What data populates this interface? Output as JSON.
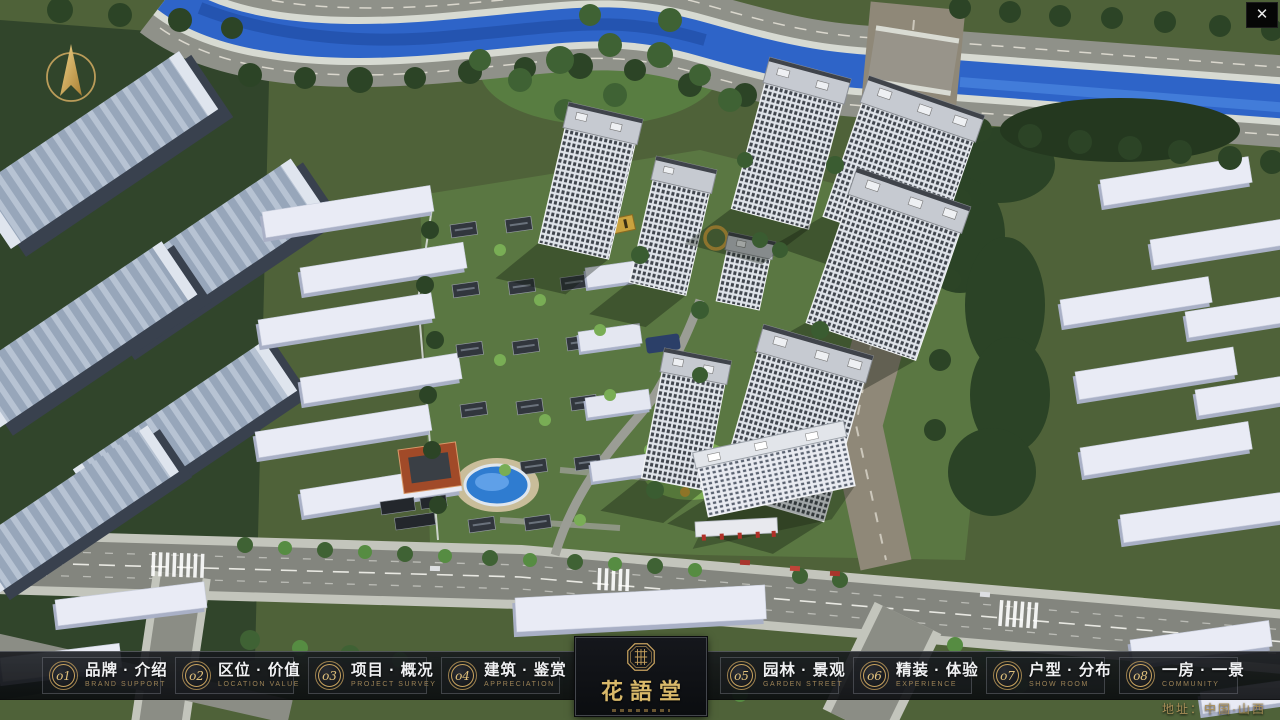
{
  "window": {
    "close_glyph": "✕"
  },
  "scene": {
    "description": "aerial 3D masterplan render of residential community"
  },
  "nav": {
    "items": [
      {
        "num": "o1",
        "zh": "品牌 · 介绍",
        "en": "BRAND SUPPORT"
      },
      {
        "num": "o2",
        "zh": "区位 · 价值",
        "en": "LOCATION VALUE"
      },
      {
        "num": "o3",
        "zh": "项目 · 概况",
        "en": "PROJECT SURVEY"
      },
      {
        "num": "o4",
        "zh": "建筑 · 鉴赏",
        "en": "APPRECIATION"
      },
      {
        "num": "o5",
        "zh": "园林 · 景观",
        "en": "GARDEN STREET"
      },
      {
        "num": "o6",
        "zh": "精装 · 体验",
        "en": "EXPERIENCE"
      },
      {
        "num": "o7",
        "zh": "户型 · 分布",
        "en": "SHOW ROOM"
      },
      {
        "num": "o8",
        "zh": "一房 · 一景",
        "en": "COMMUNITY"
      }
    ],
    "logo": {
      "title": "花語堂"
    },
    "address": "地址：中国·山西"
  },
  "colors": {
    "gold": "#c9a35f",
    "bar_bg": "#101318",
    "river": "#2e64c8"
  }
}
